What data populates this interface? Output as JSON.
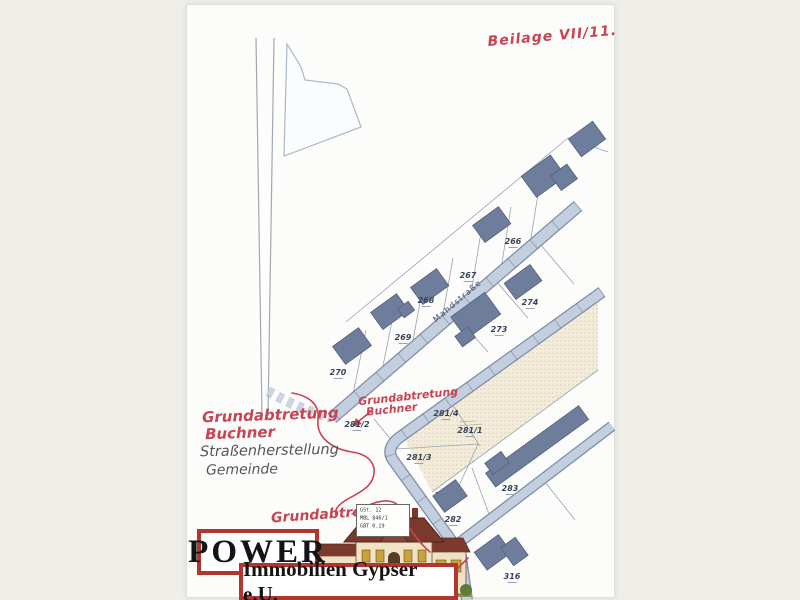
{
  "annotations": {
    "beilage": "Beilage VII/11.",
    "left_red": [
      "Grundabtretung",
      "Buchner"
    ],
    "left_pencil": [
      "Straßenherstellung",
      "Gemeinde"
    ],
    "center_red": [
      "Grundabtretung",
      "Buchner"
    ],
    "bottom_red": "Grundabtretung"
  },
  "map": {
    "street_name": "Mahdstraße",
    "parcels": [
      "270",
      "269",
      "268",
      "267",
      "266",
      "274",
      "273",
      "281/2",
      "281/4",
      "281/1",
      "281/3",
      "283",
      "282",
      "316"
    ],
    "stamp_rows": [
      "GSt. 12",
      "MBL 846/1",
      "GBT 0.19"
    ]
  },
  "logo": {
    "title": "POWER",
    "subtitle": "Immobilien Gypser e.U."
  },
  "colors": {
    "annotation_red": "#c84453",
    "road_fill": "#c3cedf",
    "road_edge": "#7e8ca6",
    "building": "#6e7d9c",
    "stipple_bg": "#f3ecda",
    "logo_red": "#b23530",
    "paper": "#fcfcfa",
    "margin_bg": "#efeee9"
  }
}
